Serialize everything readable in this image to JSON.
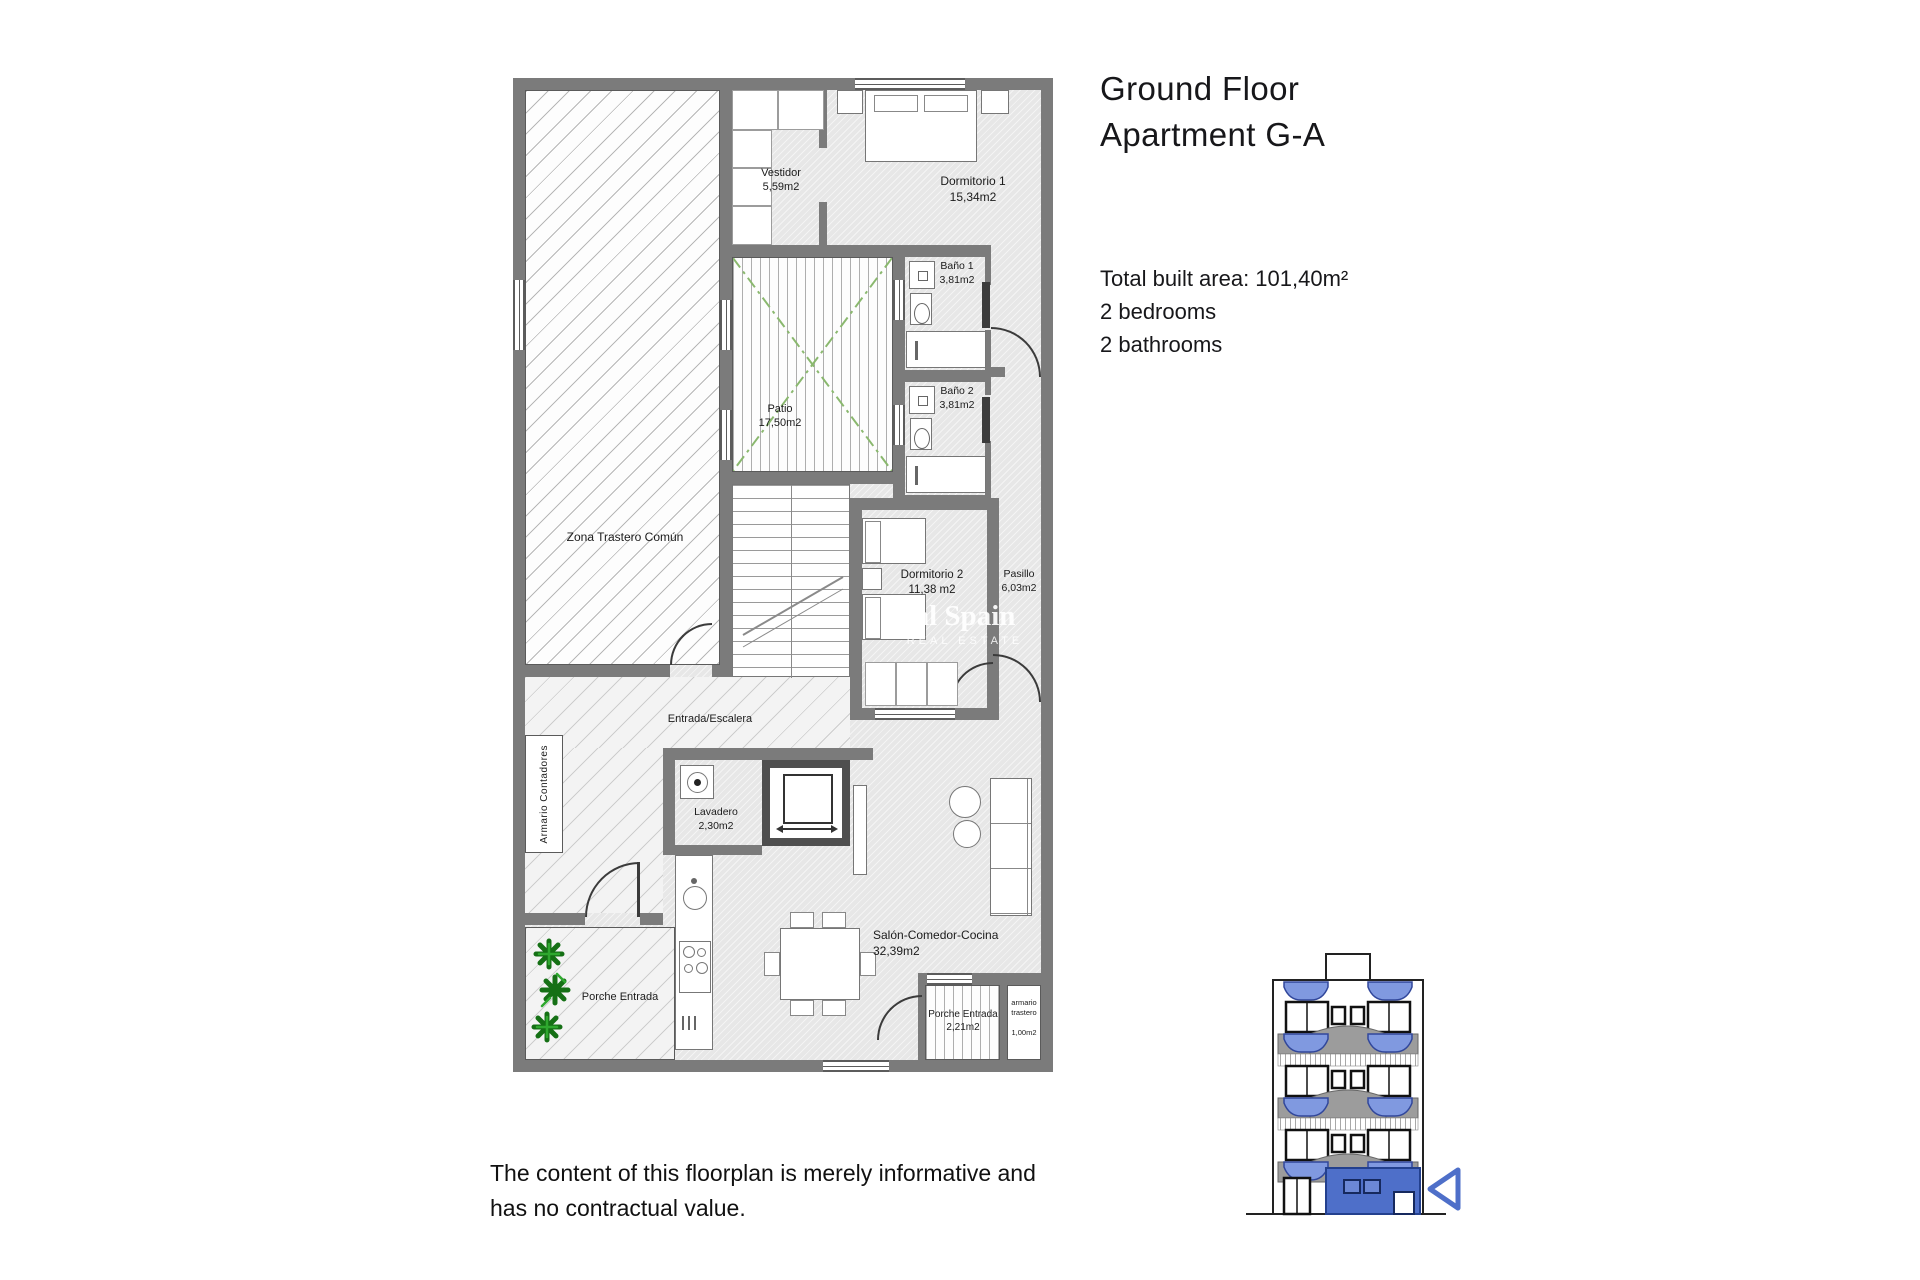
{
  "title": {
    "line1": "Ground Floor",
    "line2": "Apartment G-A"
  },
  "info": {
    "total_area": "Total built area: 101,40m²",
    "bedrooms": "2 bedrooms",
    "bathrooms": "2 bathrooms"
  },
  "disclaimer": {
    "line1": "The content of this floorplan is merely informative and",
    "line2": "has no contractual value."
  },
  "watermark": {
    "line1": "al Spain",
    "line2": "REAL ESTATE"
  },
  "plan": {
    "rooms": {
      "zona_trastero": {
        "name": "Zona Trastero Común"
      },
      "vestidor": {
        "name": "Vestidor",
        "area": "5,59m2"
      },
      "dormitorio1": {
        "name": "Dormitorio 1",
        "area": "15,34m2"
      },
      "bano1": {
        "name": "Baño 1",
        "area": "3,81m2"
      },
      "bano2": {
        "name": "Baño 2",
        "area": "3,81m2"
      },
      "patio": {
        "name": "Patio",
        "area": "17,50m2"
      },
      "dormitorio2": {
        "name": "Dormitorio 2",
        "area": "11,38 m2"
      },
      "pasillo": {
        "name": "Pasillo",
        "area": "6,03m2"
      },
      "entrada": {
        "name": "Entrada/Escalera"
      },
      "lavadero": {
        "name": "Lavadero",
        "area": "2,30m2"
      },
      "salon": {
        "name": "Salón-Comedor-Cocina",
        "area": "32,39m2"
      },
      "porche_izq": {
        "name": "Porche Entrada"
      },
      "porche_sur": {
        "name": "Porche Entrada",
        "area": "2,21m2"
      },
      "armario_trastero": {
        "line1": "armario",
        "line2": "trastero",
        "area": "1,00m2"
      },
      "armario_contadores": {
        "name": "Armario Contadores"
      }
    }
  },
  "colors": {
    "wall": "#7b7b7b",
    "highlight_blue": "#4e6fc9",
    "awning_blue": "#8099e0",
    "plant_green": "#1f8a1f",
    "patio_green": "#8ab86e"
  }
}
